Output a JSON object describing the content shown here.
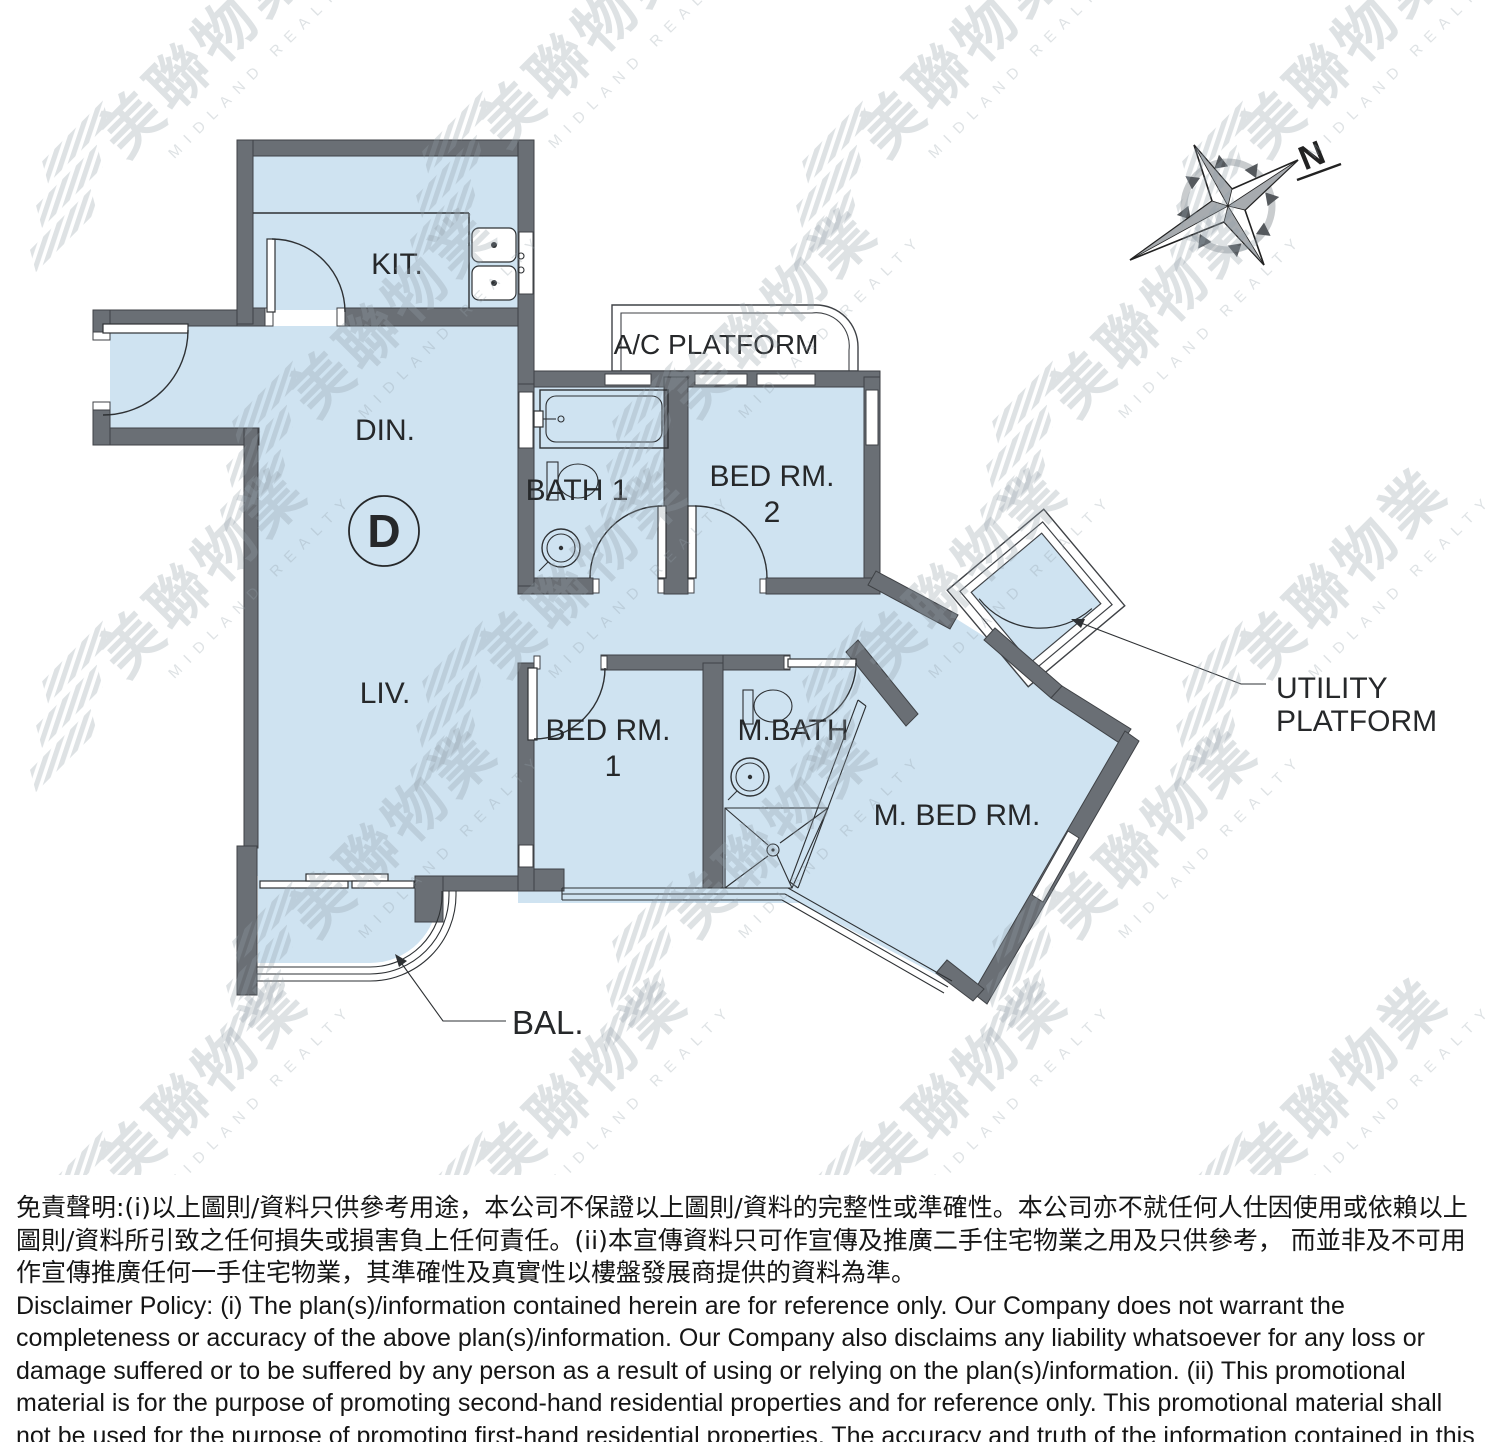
{
  "floor_plan": {
    "unit_label": "D",
    "labels": {
      "kitchen": "KIT.",
      "dining": "DIN.",
      "living": "LIV.",
      "bath1": "BATH 1",
      "bedroom2_name": "BED RM.",
      "bedroom2_no": "2",
      "bedroom1_name": "BED RM.",
      "bedroom1_no": "1",
      "master_bath": "M.BATH",
      "master_bedroom": "M. BED RM.",
      "ac_platform": "A/C PLATFORM",
      "utility_platform_line1": "UTILITY",
      "utility_platform_line2": "PLATFORM",
      "balcony": "BAL.",
      "north": "N"
    },
    "colors": {
      "wall": "#6a6f75",
      "floor": "#cfe3f1",
      "line": "#2e3134",
      "text": "#26282a"
    }
  },
  "watermark": {
    "zh": "美聯物業",
    "en": "MIDLAND REALTY"
  },
  "disclaimer": {
    "chinese": "免責聲明:(i)以上圖則/資料只供參考用途，本公司不保證以上圖則/資料的完整性或準確性。本公司亦不就任何人仕因使用或依賴以上圖則/資料所引致之任何損失或損害負上任何責任。(ii)本宣傳資料只可作宣傳及推廣二手住宅物業之用及只供參考， 而並非及不可用作宣傳推廣任何一手住宅物業，其準確性及真實性以樓盤發展商提供的資料為準。",
    "english": "Disclaimer Policy: (i) The plan(s)/information contained herein are for reference only. Our Company does not warrant the completeness or accuracy of the above plan(s)/information. Our Company also disclaims any liability whatsoever for any loss or damage suffered or to be suffered by any person as a result of using or relying on the plan(s)/information. (ii) This promotional material is for the purpose of promoting second-hand residential properties and for reference only. This promotional material shall not be used for the purpose of promoting first-hand residential properties. The accuracy and truth of the information contained in this promotional material shall be subject to information provided by the developers."
  }
}
